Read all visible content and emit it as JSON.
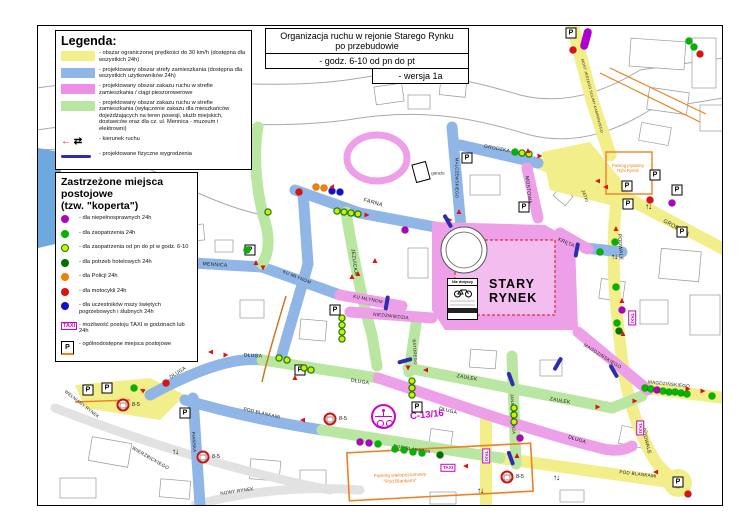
{
  "title_box": {
    "line1": "Organizacja ruchu w rejonie Starego Rynku",
    "line2": "po przebudowie",
    "line3": "- godz. 6-10 od pn do pt",
    "line4": "- wersja 1a"
  },
  "legend": {
    "title": "Legenda:",
    "items": [
      {
        "type": "swatch",
        "color": "#f2ef8a",
        "text": "- obszar ograniczonej prędkości do 30 km/h (dostępna dla wszystkich 24h)"
      },
      {
        "type": "swatch",
        "color": "#8fb6e6",
        "text": "- projektowany obszar strefy zamieszkania (dostępna dla wszystkich użytkowników 24h)"
      },
      {
        "type": "swatch",
        "color": "#ee8fe6",
        "text": "- projektowany obszar zakazu ruchu w strefie zamieszkania / ciągi pieszorowerowe"
      },
      {
        "type": "swatch",
        "color": "#b9e6a0",
        "text": "- projektowany obszar zakazu ruchu w strefie zamieszkania (wyłączenie zakazu dla mieszkańców dojeżdżających na teren posesji, służb miejskich, dostawców oraz dla cz. ul. Mennica - muzeum i elektrowni)"
      },
      {
        "type": "arrows",
        "text": "- kierunek ruchu"
      },
      {
        "type": "line",
        "color": "#2d2db0",
        "text": "- projektowane fizyczne wygrodzenia"
      }
    ]
  },
  "parking_legend": {
    "title_line1": "Zastrzeżone miejsca postojowe",
    "title_line2": "(tzw. \"koperta\")",
    "items": [
      {
        "marker": "purple",
        "text": "- dla niepełnosprawnych 24h"
      },
      {
        "marker": "green",
        "text": "- dla zaopatrzenia 24h"
      },
      {
        "marker": "yg",
        "text": "- dla zaopatrzenia od pn do pt w godz. 6-10"
      },
      {
        "marker": "dkgreen",
        "text": "- dla potrzeb hotelowych 24h"
      },
      {
        "marker": "orange",
        "text": "- dla Policji 24h"
      },
      {
        "marker": "red",
        "text": "- dla motocykli 24h"
      },
      {
        "marker": "blue",
        "text": "- dla uczestników mszy świętych pogrzebowych i ślubnych 24h"
      },
      {
        "marker": "taxi",
        "text": "- możliwość postoju TAXI w godzinach lub 24h"
      },
      {
        "marker": "ppublic",
        "text": "- ogólnodostępne miejsca postojowe"
      }
    ]
  },
  "colors": {
    "purple": "#b000c0",
    "green": "#00b400",
    "yg_fill": "#dde800",
    "yg_ring": "#008800",
    "dkgreen": "#007000",
    "orange": "#f08000",
    "red": "#e01010",
    "blue": "#1010d0",
    "road_yellow": "#f2ef8a",
    "road_blue": "#8fb6e6",
    "road_green": "#b9e6a0",
    "road_pink": "#eda0e8",
    "barrier": "#2d2db0",
    "taxi_magenta": "#cc00cc",
    "orange_line": "#f08020"
  },
  "map": {
    "square_label": "STARY\nRYNEK",
    "rynek_sign_text": "Nie dotyczy",
    "c13_label": "C-13/16",
    "taxi_label": "TAXI",
    "street_labels": [
      [
        "FARNA",
        373,
        203,
        16,
        5.5
      ],
      [
        "MALCZEWSKIEGO",
        457,
        178,
        90,
        4.2
      ],
      [
        "GRODZKA",
        497,
        149,
        11,
        5
      ],
      [
        "GRODZKA",
        676,
        228,
        29,
        5.5
      ],
      [
        "MOSTOWA",
        528,
        190,
        84,
        5
      ],
      [
        "KRĘTA",
        566,
        243,
        24,
        5
      ],
      [
        "MENNICA",
        215,
        265,
        4,
        5
      ],
      [
        "KU MŁYNOM",
        297,
        277,
        22,
        4.6
      ],
      [
        "KU MŁYNOM",
        368,
        299,
        11,
        4.6
      ],
      [
        "JEZUICKA",
        354,
        262,
        83,
        5
      ],
      [
        "NIEDŹWIEDZIA",
        391,
        316,
        6,
        4.6
      ],
      [
        "JATKI",
        585,
        196,
        70,
        4.4
      ],
      [
        "PODWALE",
        620,
        247,
        86,
        5
      ],
      [
        "PODWALE",
        646,
        441,
        76,
        5
      ],
      [
        "MAGDZIŃSKIEGO",
        602,
        357,
        32,
        4.8
      ],
      [
        "MAGDZIŃSKIEGO",
        669,
        384,
        6,
        4.6
      ],
      [
        "ZAUŁEK",
        467,
        378,
        10,
        5
      ],
      [
        "ZAUŁEK",
        560,
        401,
        10,
        5
      ],
      [
        "BATOREGO",
        415,
        352,
        86,
        4.2
      ],
      [
        "JANA KAZIMIERZA",
        513,
        414,
        87,
        4.2
      ],
      [
        "DŁUGA",
        178,
        373,
        -33,
        5
      ],
      [
        "DŁUGA",
        253,
        356,
        4,
        5
      ],
      [
        "DŁUGA",
        360,
        382,
        9,
        5
      ],
      [
        "DŁUGA",
        448,
        411,
        14,
        5
      ],
      [
        "DŁUGA",
        577,
        440,
        17,
        5
      ],
      [
        "POD BLANKAMI",
        262,
        413,
        13,
        4.6
      ],
      [
        "POD BLANKAMI",
        412,
        449,
        9,
        4.6
      ],
      [
        "POD BLANKAMI",
        638,
        474,
        7,
        4.6
      ],
      [
        "PIAŃSKA",
        194,
        442,
        86,
        4.4
      ],
      [
        "WEŁNIANY RYNEK",
        82,
        404,
        38,
        4.4
      ],
      [
        "WIERZBICKIEGO",
        150,
        459,
        30,
        4.8
      ],
      [
        "NOWY RYNEK",
        237,
        491,
        -8,
        4.6
      ],
      [
        "MOST JERZEGO SULIMY-KAMIŃSKIEGO",
        592,
        96,
        75,
        3.6
      ]
    ],
    "special_labels": [
      [
        "garaże",
        438,
        173,
        0,
        4.4,
        "#333",
        40
      ],
      [
        "Parking prywatny\nRybi Rynek",
        628,
        169,
        0,
        4.2,
        "#f08020",
        44
      ],
      [
        "Parking wielopoziomowy\n\"Pod Blankami\"",
        400,
        479,
        -2,
        4.8,
        "#f08020",
        115
      ],
      [
        "C-13/16",
        427,
        416,
        -6,
        9.5,
        "#d000d0",
        60
      ]
    ],
    "dots": [
      [
        "red",
        299,
        192
      ],
      [
        "orange",
        316,
        187
      ],
      [
        "orange",
        324,
        188
      ],
      [
        "blue",
        332,
        191
      ],
      [
        "blue",
        340,
        192
      ],
      [
        "yg",
        268,
        212
      ],
      [
        "yg",
        337,
        211
      ],
      [
        "yg",
        344,
        212
      ],
      [
        "yg",
        351,
        213
      ],
      [
        "yg",
        358,
        214
      ],
      [
        "purple",
        405,
        230
      ],
      [
        "green",
        515,
        152
      ],
      [
        "yg",
        522,
        153
      ],
      [
        "yg",
        529,
        154
      ],
      [
        "red",
        573,
        50
      ],
      [
        "green",
        689,
        41
      ],
      [
        "green",
        694,
        47
      ],
      [
        "red",
        700,
        54
      ],
      [
        "red",
        650,
        200
      ],
      [
        "purple",
        672,
        203
      ],
      [
        "green",
        615,
        242
      ],
      [
        "green",
        600,
        252
      ],
      [
        "green",
        616,
        287
      ],
      [
        "purple",
        622,
        310
      ],
      [
        "green",
        617,
        323
      ],
      [
        "dkgreen",
        619,
        331
      ],
      [
        "yg",
        342,
        318
      ],
      [
        "yg",
        342,
        325
      ],
      [
        "yg",
        342,
        332
      ],
      [
        "yg",
        342,
        339
      ],
      [
        "green",
        247,
        250
      ],
      [
        "yg",
        279,
        358
      ],
      [
        "yg",
        287,
        360
      ],
      [
        "yg",
        304,
        368
      ],
      [
        "yg",
        311,
        370
      ],
      [
        "green",
        134,
        388
      ],
      [
        "red",
        166,
        383
      ],
      [
        "yg",
        412,
        381
      ],
      [
        "yg",
        412,
        388
      ],
      [
        "yg",
        412,
        395
      ],
      [
        "yg",
        514,
        408
      ],
      [
        "yg",
        514,
        415
      ],
      [
        "yg",
        514,
        422
      ],
      [
        "purple",
        520,
        438
      ],
      [
        "green",
        645,
        388
      ],
      [
        "green",
        651,
        389
      ],
      [
        "purple",
        657,
        390
      ],
      [
        "green",
        663,
        391
      ],
      [
        "green",
        669,
        392
      ],
      [
        "green",
        675,
        392
      ],
      [
        "green",
        681,
        393
      ],
      [
        "green",
        687,
        394
      ],
      [
        "green",
        712,
        396
      ],
      [
        "purple",
        360,
        442
      ],
      [
        "purple",
        369,
        443
      ],
      [
        "green",
        378,
        444
      ],
      [
        "green",
        395,
        449
      ],
      [
        "green",
        404,
        450
      ],
      [
        "green",
        413,
        452
      ],
      [
        "green",
        422,
        453
      ],
      [
        "dkgreen",
        440,
        455
      ],
      [
        "red",
        688,
        494
      ]
    ],
    "arrows": [
      [
        597,
        181,
        270
      ],
      [
        605,
        187,
        270
      ],
      [
        688,
        389,
        90
      ],
      [
        703,
        391,
        90
      ],
      [
        635,
        401,
        90
      ],
      [
        616,
        228,
        0
      ],
      [
        623,
        333,
        0
      ],
      [
        540,
        156,
        90
      ],
      [
        367,
        215,
        90
      ],
      [
        333,
        186,
        30
      ],
      [
        450,
        220,
        90
      ],
      [
        459,
        211,
        0
      ],
      [
        256,
        262,
        0
      ],
      [
        263,
        268,
        180
      ],
      [
        352,
        276,
        0
      ],
      [
        375,
        260,
        0
      ],
      [
        358,
        273,
        0
      ],
      [
        210,
        352,
        270
      ],
      [
        226,
        355,
        90
      ],
      [
        295,
        377,
        0
      ],
      [
        425,
        370,
        270
      ],
      [
        598,
        407,
        90
      ],
      [
        408,
        368,
        180
      ],
      [
        517,
        455,
        0
      ],
      [
        302,
        420,
        270
      ],
      [
        465,
        466,
        270
      ],
      [
        655,
        472,
        270
      ],
      [
        528,
        150,
        0
      ],
      [
        622,
        300,
        0
      ],
      [
        142,
        390,
        300
      ]
    ],
    "double_arrows": [
      [
        480,
        491
      ],
      [
        175,
        452
      ],
      [
        614,
        257
      ],
      [
        556,
        478
      ],
      [
        648,
        207
      ]
    ],
    "barriers": [
      [
        448,
        221,
        60
      ],
      [
        577,
        250,
        100
      ],
      [
        387,
        303,
        100
      ],
      [
        405,
        361,
        165
      ],
      [
        511,
        379,
        70
      ],
      [
        558,
        364,
        120
      ],
      [
        614,
        371,
        60
      ],
      [
        511,
        458,
        70
      ]
    ],
    "parking_icons": [
      [
        571,
        33
      ],
      [
        467,
        158
      ],
      [
        627,
        186
      ],
      [
        655,
        175
      ],
      [
        677,
        190
      ],
      [
        628,
        204
      ],
      [
        682,
        232
      ],
      [
        250,
        250
      ],
      [
        524,
        207
      ],
      [
        335,
        310
      ],
      [
        417,
        407
      ],
      [
        300,
        370
      ],
      [
        88,
        390
      ],
      [
        107,
        388
      ],
      [
        185,
        413
      ],
      [
        678,
        482
      ]
    ],
    "taxi_boxes": [
      [
        632,
        318,
        1
      ],
      [
        640,
        428,
        1
      ],
      [
        448,
        468,
        0
      ],
      [
        486,
        456,
        1
      ]
    ],
    "no_stop_signs": [
      {
        "x": 123,
        "y": 405,
        "label": "8-5"
      },
      {
        "x": 203,
        "y": 457,
        "label": "8-5"
      },
      {
        "x": 330,
        "y": 419,
        "label": "8-5"
      },
      {
        "x": 507,
        "y": 477,
        "label": "8-5"
      }
    ]
  }
}
